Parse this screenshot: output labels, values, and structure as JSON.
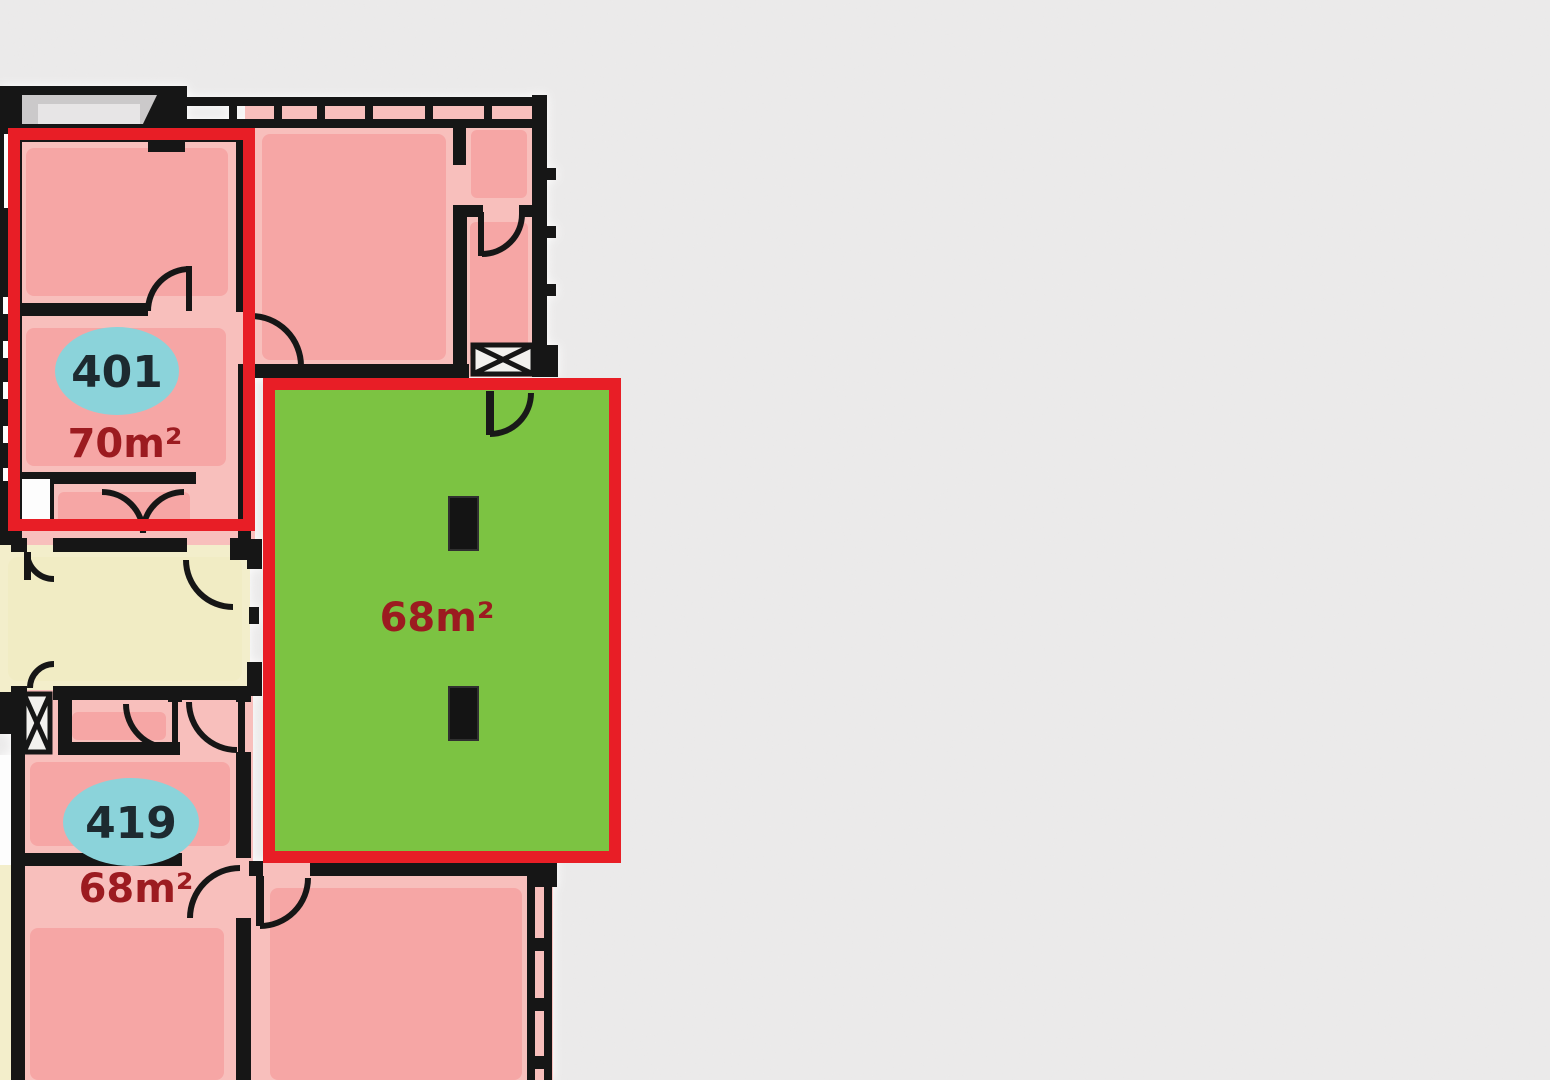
{
  "colors": {
    "background": "#ebeaea",
    "speckle": "#d9d7d7",
    "wall": "#191919",
    "room_pink": "#f8bfbc",
    "room_pink_inner": "#f6a6a5",
    "corridor_cream": "#f3eecb",
    "corridor_cream_inner": "#f1ecc4",
    "balcony_gray": "#cbc9ca",
    "balcony_gray_light": "#e7e5e6",
    "highlight_green": "#7cc342",
    "highlight_red": "#e81e26",
    "badge_cyan": "#8bd3da",
    "badge_text": "#1d2a30",
    "area_text": "#9c1b20",
    "window_white": "#fdfdfd",
    "shaft_white": "#f2f1ee"
  },
  "units": {
    "unit_401": {
      "badge": "401",
      "area": "70m²",
      "highlighted": true
    },
    "unit_419": {
      "badge": "419",
      "area": "68m²",
      "highlighted": false
    },
    "unit_green": {
      "area": "68m²",
      "highlighted": true
    }
  }
}
